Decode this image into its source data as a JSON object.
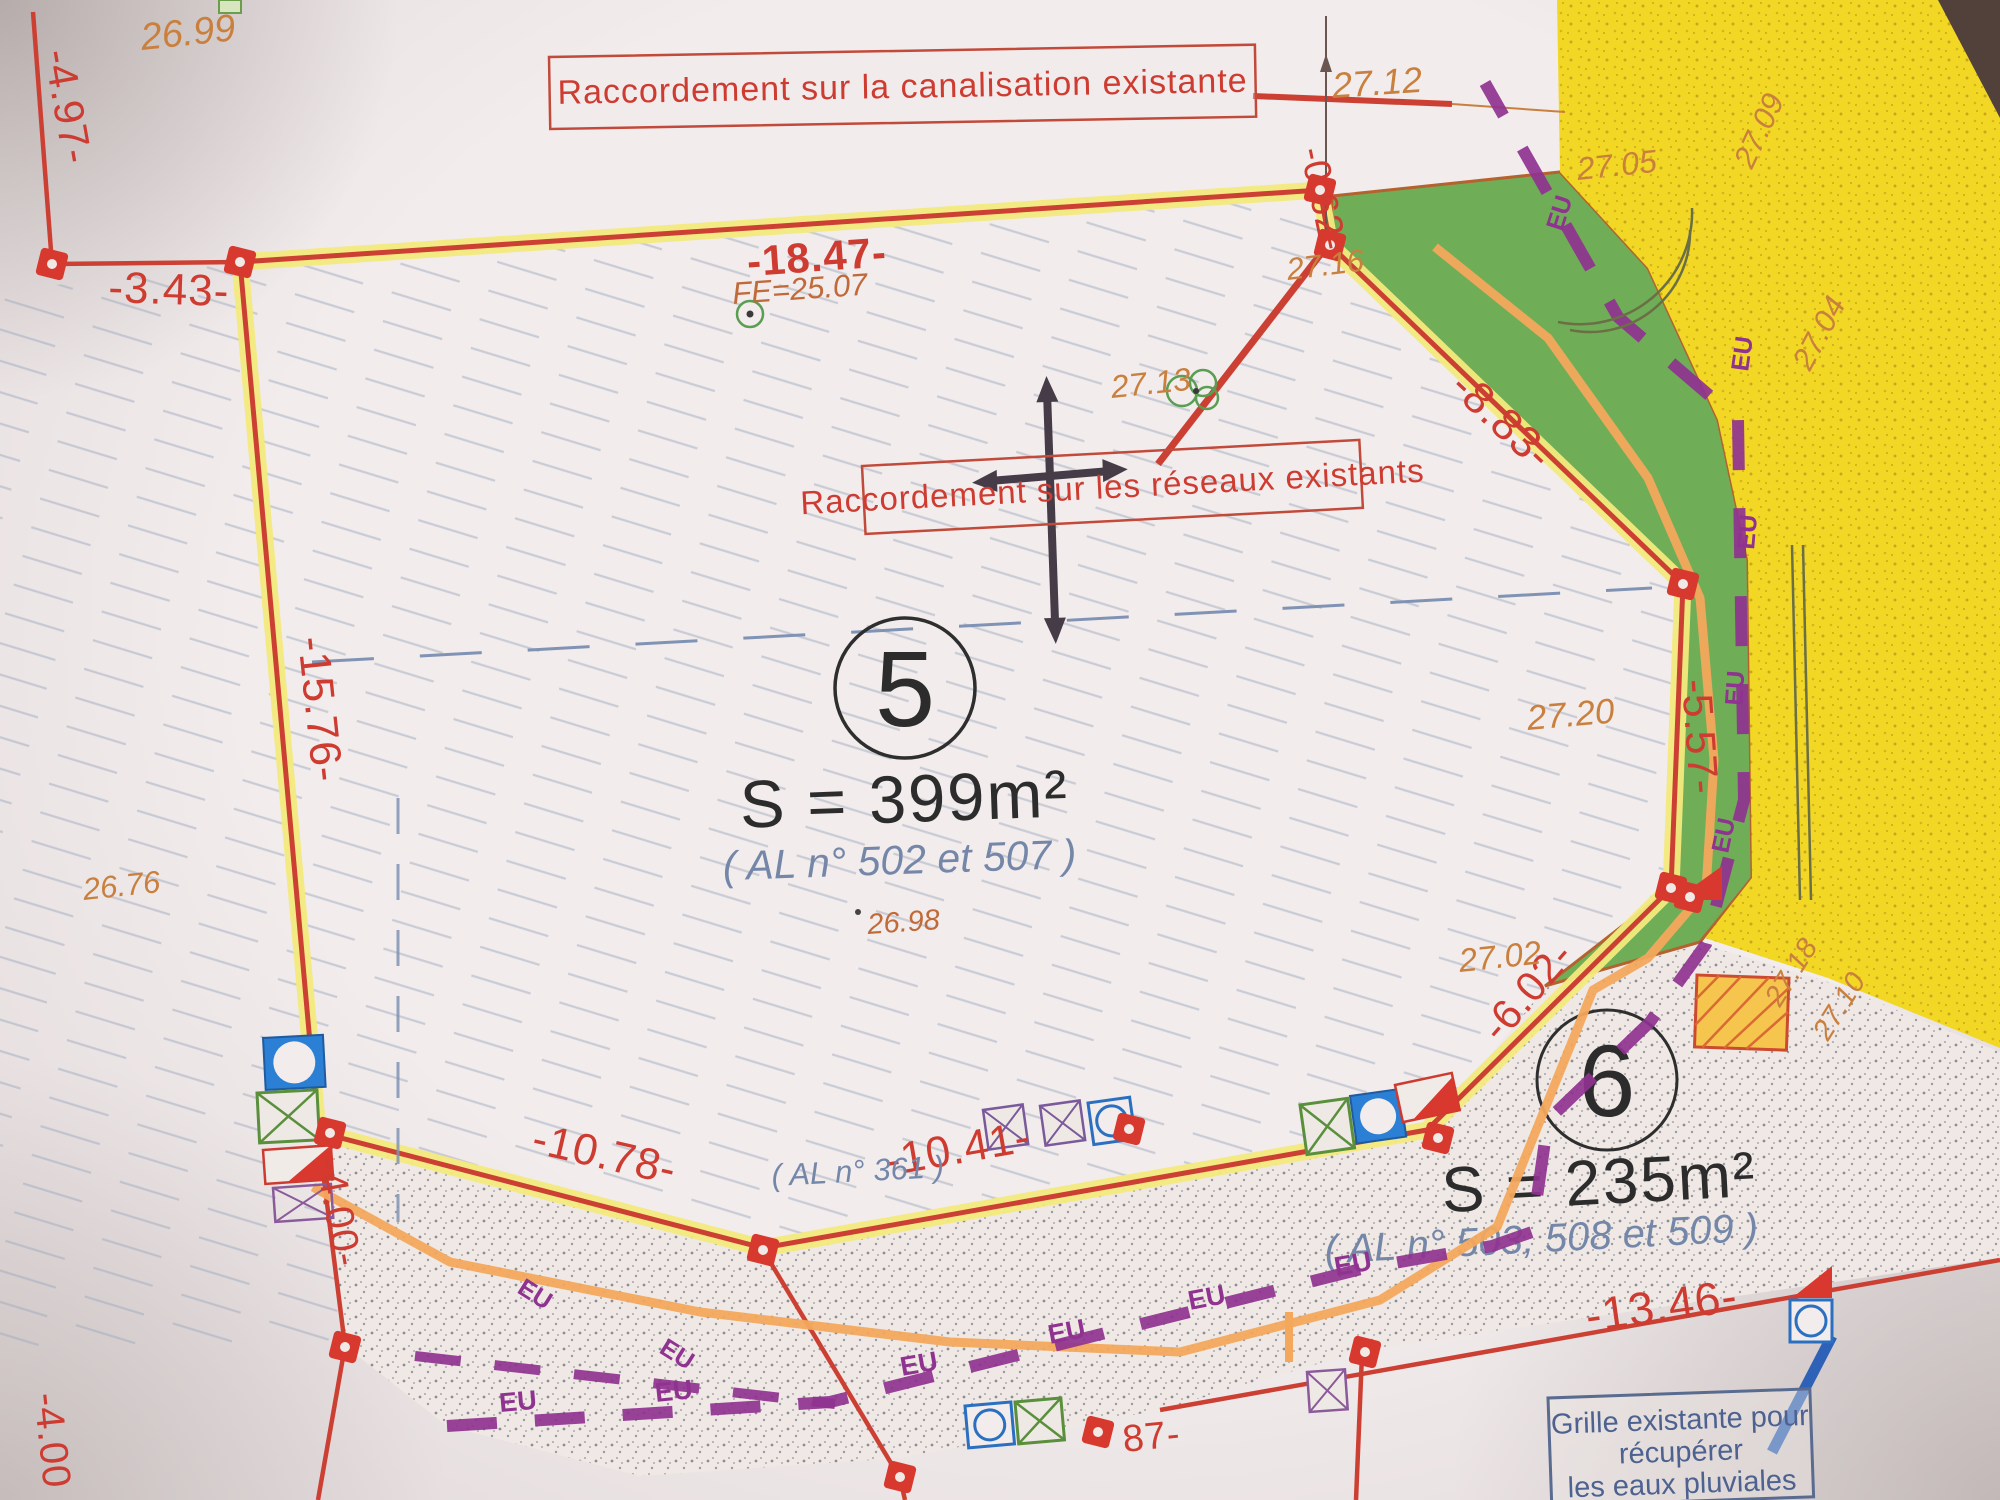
{
  "banners": {
    "canalisation": "Raccordement sur la canalisation existante",
    "reseaux": "Raccordement sur les réseaux existants",
    "grille_line1": "Grille existante pour",
    "grille_line2": "récupérer",
    "grille_line3": "les eaux pluviales"
  },
  "parcels": [
    {
      "number": "5",
      "area": "S = 399m²",
      "references": "( AL n° 502 et 507 )"
    },
    {
      "number": "6",
      "area": "S = 235m²",
      "references": "( AL n° 503, 508 et 509 )"
    }
  ],
  "neighbor_reference": "( AL n° 361 )",
  "dimensions": {
    "d4_97": "-4.97-",
    "d3_43": "-3.43-",
    "d18_47": "-18.47-",
    "d0_62": "-0.62-",
    "d8_83": "-8.83-",
    "d15_76": "-15.76-",
    "d5_57": "-5.57-",
    "d6_02": "-6.02-",
    "d10_78": "-10.78-",
    "d10_41": "-10.41-",
    "d4_00_left": "-4.00-",
    "d4_00_bottom": "-4.00",
    "d13_46": "-13.46-",
    "d87": "87-"
  },
  "elevations": {
    "e26_99": "26.99",
    "e27_12": "27.12",
    "e27_16": "27.16",
    "e27_05": "27.05",
    "e27_09": "27.09",
    "e27_04": "27.04",
    "e27_13": "27.13",
    "e26_98": "26.98",
    "e26_76": "26.76",
    "e27_20": "27.20",
    "e27_02": "27.02",
    "e27_18": "27.18",
    "e27_10": "27.10"
  },
  "utilities": {
    "sewer_label": "EU",
    "invert_level": "FE=25.07"
  },
  "colors": {
    "boundary_red": "#cc4034",
    "band_yellow": "#f3ea7d",
    "verge_green": "#6fae57",
    "field_yellow": "#f2d725",
    "sewer_purple": "#8f3290",
    "water_orange": "#f3a85c",
    "note_blue": "#7487a9",
    "label_orange": "#c9803e",
    "label_red": "#ce3b30"
  }
}
